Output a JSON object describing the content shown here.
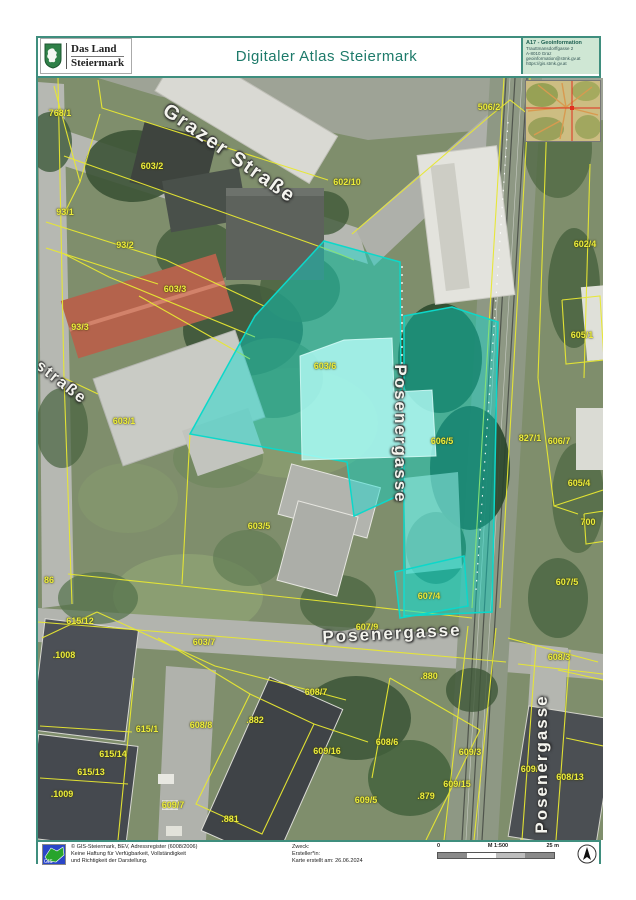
{
  "header": {
    "logo": {
      "line1": "Das Land",
      "line2": "Steiermark"
    },
    "title": "Digitaler Atlas Steiermark",
    "info": {
      "line1": "A17 - Geoinformation",
      "line2": "Trauttmansdorffgasse 2",
      "line3": "A-8010 Graz",
      "line4": "geoinformation@stmk.gv.at",
      "line5": "https://gis.stmk.gv.at"
    }
  },
  "map": {
    "highlight_color": "#0cd8ca",
    "parcel_line_color": "#e8e832",
    "street_labels": [
      {
        "t": "Grazer Straße",
        "x": 191,
        "y": 76,
        "r": 35,
        "s": 20
      },
      {
        "t": "straße",
        "x": 23,
        "y": 305,
        "r": 38,
        "s": 16
      },
      {
        "t": "Posenergasse",
        "x": 362,
        "y": 356,
        "r": 90,
        "s": 17
      },
      {
        "t": "Posenergasse",
        "x": 354,
        "y": 556,
        "r": -3,
        "s": 17
      },
      {
        "t": "Posenergasse",
        "x": 504,
        "y": 686,
        "r": -90,
        "s": 17
      }
    ],
    "parcel_labels": [
      {
        "t": "768/1",
        "x": 22,
        "y": 35
      },
      {
        "t": "603/2",
        "x": 114,
        "y": 88
      },
      {
        "t": "93/1",
        "x": 27,
        "y": 134
      },
      {
        "t": "602/10",
        "x": 309,
        "y": 104
      },
      {
        "t": "506/2",
        "x": 451,
        "y": 29
      },
      {
        "t": "93/2",
        "x": 87,
        "y": 167
      },
      {
        "t": "602/4",
        "x": 547,
        "y": 166
      },
      {
        "t": "603/3",
        "x": 137,
        "y": 211
      },
      {
        "t": "93/3",
        "x": 42,
        "y": 249
      },
      {
        "t": "605/1",
        "x": 544,
        "y": 257
      },
      {
        "t": "603/6",
        "x": 287,
        "y": 288
      },
      {
        "t": "603/1",
        "x": 86,
        "y": 343
      },
      {
        "t": "827/1",
        "x": 492,
        "y": 360
      },
      {
        "t": "606/7",
        "x": 521,
        "y": 363
      },
      {
        "t": "606/5",
        "x": 404,
        "y": 363
      },
      {
        "t": "605/4",
        "x": 541,
        "y": 405
      },
      {
        "t": "700",
        "x": 550,
        "y": 444
      },
      {
        "t": "603/5",
        "x": 221,
        "y": 448
      },
      {
        "t": "86",
        "x": 11,
        "y": 502
      },
      {
        "t": "607/5",
        "x": 529,
        "y": 504
      },
      {
        "t": "607/4",
        "x": 391,
        "y": 518
      },
      {
        "t": "615/12",
        "x": 42,
        "y": 543
      },
      {
        "t": "607/9",
        "x": 329,
        "y": 549
      },
      {
        "t": "603/7",
        "x": 166,
        "y": 564
      },
      {
        "t": ".1008",
        "x": 26,
        "y": 577
      },
      {
        "t": "608/3",
        "x": 521,
        "y": 579
      },
      {
        "t": ".880",
        "x": 391,
        "y": 598
      },
      {
        "t": "608/7",
        "x": 278,
        "y": 614
      },
      {
        "t": ".882",
        "x": 217,
        "y": 642
      },
      {
        "t": "608/8",
        "x": 163,
        "y": 647
      },
      {
        "t": "615/1",
        "x": 109,
        "y": 651
      },
      {
        "t": "608/6",
        "x": 349,
        "y": 664
      },
      {
        "t": "609/16",
        "x": 289,
        "y": 673
      },
      {
        "t": "615/14",
        "x": 75,
        "y": 676
      },
      {
        "t": "609/3",
        "x": 432,
        "y": 674
      },
      {
        "t": "609/4",
        "x": 494,
        "y": 691
      },
      {
        "t": "615/13",
        "x": 53,
        "y": 694
      },
      {
        "t": "608/13",
        "x": 532,
        "y": 699
      },
      {
        "t": "609/15",
        "x": 419,
        "y": 706
      },
      {
        "t": ".1009",
        "x": 24,
        "y": 716
      },
      {
        "t": ".879",
        "x": 388,
        "y": 718
      },
      {
        "t": "609/5",
        "x": 328,
        "y": 722
      },
      {
        "t": "609/7",
        "x": 135,
        "y": 727
      },
      {
        "t": ".881",
        "x": 192,
        "y": 741
      }
    ]
  },
  "footer": {
    "copyright_lines": [
      "© GIS-Steiermark, BEV, Adressregister (6008/2006)",
      "Keine Haftung für Verfügbarkeit, Vollständigkeit",
      "und Richtigkeit der Darstellung."
    ],
    "zweck": "Zweck:",
    "ersteller": "Ersteller*in:",
    "created": "Karte erstellt am: 26.06.2024",
    "scale": {
      "zero": "0",
      "ratio": "M 1:500",
      "distance": "25 m"
    }
  }
}
